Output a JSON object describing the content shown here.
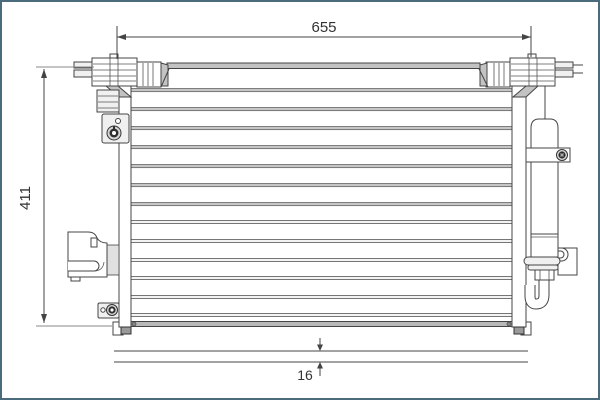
{
  "frame": {
    "border_color": "#4a6b7c",
    "background": "#ffffff"
  },
  "diagram": {
    "dimensions": {
      "overall_width": "655",
      "overall_height": "411",
      "core_depth": "16"
    },
    "palette": {
      "line": "#444444",
      "dimension_text": "#333333",
      "tube_gray": "#c6c6c6",
      "bar_gray": "#b8b8b8",
      "plate_gray": "#f0f0f0",
      "bolt_dark": "#2e2e2e"
    }
  }
}
